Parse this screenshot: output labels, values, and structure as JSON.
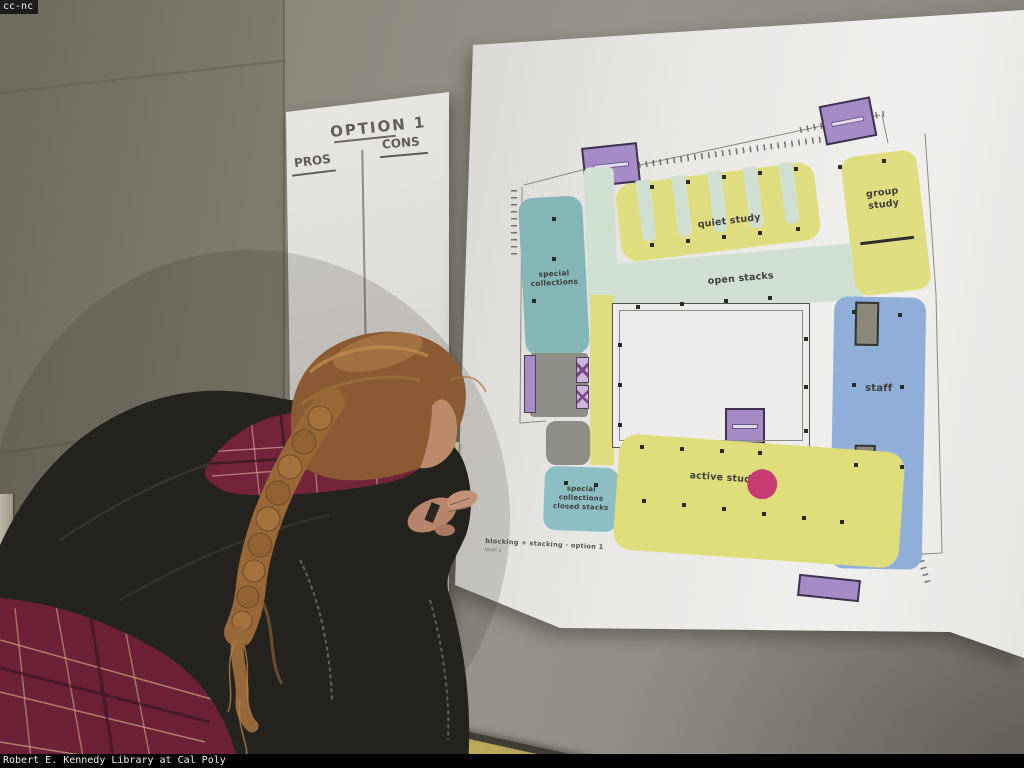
{
  "overlay": {
    "top_credit": "cc-nc",
    "bottom_credit": "Robert E. Kennedy Library at Cal Poly"
  },
  "left_poster": {
    "title": "OPTION 1",
    "pros_label": "PROS",
    "cons_label": "CONS"
  },
  "sticky_note": {
    "text": "lack of community in closed stacks"
  },
  "floor_plan": {
    "caption": {
      "line1": "blocking + stacking · option 1",
      "line2": "level 1"
    },
    "zones": [
      {
        "id": "special-collections",
        "label": "special collections",
        "color": "#85b6b7"
      },
      {
        "id": "quiet-study",
        "label": "quiet study",
        "color": "#e0dd80"
      },
      {
        "id": "open-stacks",
        "label": "open stacks",
        "color": "#cfe0d2"
      },
      {
        "id": "group-study",
        "label": "group study",
        "color": "#e0dd80"
      },
      {
        "id": "staff",
        "label": "staff",
        "color": "#8fafd9"
      },
      {
        "id": "closed-stacks",
        "label": "special collections closed stacks",
        "color": "#8cbec3"
      },
      {
        "id": "active-study",
        "label": "active study",
        "color": "#dfdc7a"
      }
    ],
    "palette": {
      "stairs_purple": "#a58cc7",
      "core_gray": "#8f8e86",
      "accent_pink": "#c73d72",
      "courtyard_white": "#edecea"
    }
  },
  "person": {
    "jacket_color": "#24231e",
    "hair_color": "#9a6836",
    "plaid_color": "#73243a"
  }
}
